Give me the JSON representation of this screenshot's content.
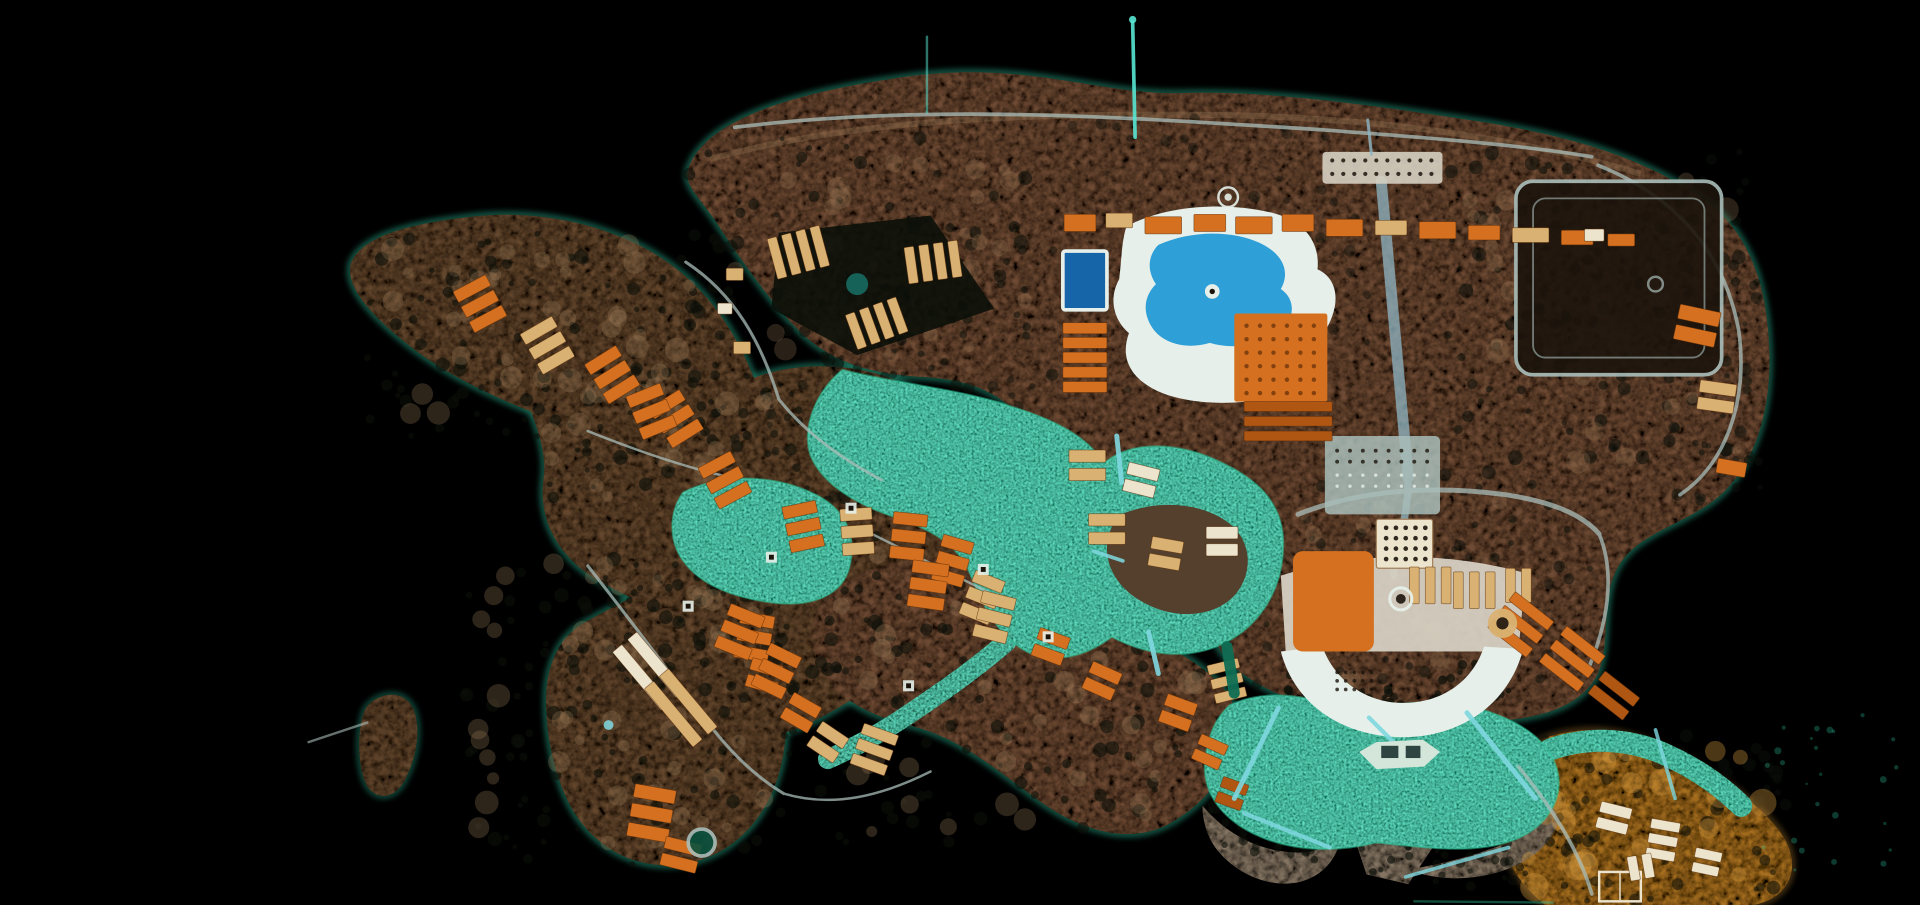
{
  "meta": {
    "title": "Aerial satellite photograph of an island lagoon resort at night, viewed from directly above on black water"
  },
  "palette": {
    "background": "#000000",
    "land": "#6e4c34",
    "land2": "#63462f",
    "land_dark": "#54402c",
    "land_light": "#a3805c",
    "gold": "#a76f24",
    "gold_light": "#d89a3e",
    "island_gray": "#857663",
    "scrub": "#0b0f09",
    "lagoon": "#0e6e54",
    "lagoon_deep": "#0a523e",
    "lagoon_bright": "#2fc49a",
    "pool_blue": "#2f9fd8",
    "pool_deep": "#1565a8",
    "deck": "#e6efe9",
    "plaza": "#d6d0c2",
    "roof_orange": "#d4701f",
    "roof_orange_dark": "#b05613",
    "roof_tan": "#d9b273",
    "building_white": "#ece4cc",
    "road": "#a9bdb9",
    "road_teal": "#8fb6c4",
    "bridge_cyan": "#7fd8e0",
    "mast": "#58e6d2",
    "coast_glow": "#35e0b4",
    "court_dark": "#1c140c",
    "water_feature": "#176a60",
    "pergola_dark": "#7a3c0e",
    "boat_white": "#d4e6da",
    "boat_dark": "#2e4440",
    "villa_stroke": "#5a2c08"
  },
  "map": {
    "villa_clusters": [
      [
        392,
        248,
        -28,
        3,
        30,
        10,
        4,
        "roof_orange"
      ],
      [
        447,
        282,
        -30,
        3,
        30,
        10,
        4,
        "roof_tan"
      ],
      [
        500,
        306,
        -32,
        3,
        30,
        10,
        4,
        "roof_orange"
      ],
      [
        552,
        342,
        -32,
        3,
        30,
        10,
        4,
        "roof_orange"
      ],
      [
        592,
        392,
        -28,
        3,
        30,
        10,
        4,
        "roof_orange"
      ],
      [
        532,
        336,
        -22,
        3,
        30,
        10,
        4,
        "roof_orange"
      ],
      [
        656,
        430,
        -12,
        3,
        28,
        10,
        4,
        "roof_orange"
      ],
      [
        700,
        434,
        -4,
        3,
        26,
        10,
        4,
        "roof_tan"
      ],
      [
        742,
        438,
        6,
        3,
        28,
        10,
        4,
        "roof_orange"
      ],
      [
        778,
        458,
        16,
        3,
        26,
        10,
        4,
        "roof_orange"
      ],
      [
        802,
        488,
        22,
        3,
        26,
        10,
        4,
        "roof_tan"
      ],
      [
        616,
        520,
        10,
        3,
        28,
        10,
        4,
        "roof_orange"
      ],
      [
        624,
        552,
        16,
        2,
        26,
        10,
        4,
        "roof_orange"
      ],
      [
        758,
        478,
        8,
        3,
        30,
        10,
        4,
        "roof_orange"
      ],
      [
        812,
        504,
        14,
        3,
        28,
        10,
        4,
        "roof_tan"
      ],
      [
        858,
        528,
        20,
        2,
        26,
        10,
        4,
        "roof_orange"
      ],
      [
        900,
        556,
        24,
        2,
        26,
        10,
        4,
        "roof_orange"
      ],
      [
        962,
        582,
        20,
        2,
        26,
        10,
        4,
        "roof_orange"
      ],
      [
        988,
        614,
        24,
        2,
        24,
        9,
        4,
        "roof_orange"
      ],
      [
        1006,
        648,
        20,
        2,
        22,
        9,
        4,
        "roof_orange_dark"
      ],
      [
        604,
        516,
        22,
        3,
        30,
        10,
        4,
        "roof_orange"
      ],
      [
        634,
        548,
        26,
        3,
        28,
        10,
        4,
        "roof_orange"
      ],
      [
        654,
        582,
        30,
        2,
        26,
        10,
        4,
        "roof_orange"
      ],
      [
        676,
        606,
        34,
        2,
        26,
        10,
        4,
        "roof_tan"
      ],
      [
        714,
        612,
        20,
        3,
        30,
        9,
        4,
        "roof_tan"
      ],
      [
        532,
        664,
        10,
        3,
        34,
        11,
        5,
        "roof_orange"
      ],
      [
        556,
        698,
        14,
        2,
        30,
        10,
        4,
        "roof_orange"
      ],
      [
        530,
        548,
        50,
        2,
        62,
        10,
        6,
        "building_white"
      ],
      [
        556,
        578,
        50,
        2,
        62,
        10,
        6,
        "roof_tan"
      ],
      [
        886,
        292,
        0,
        5,
        36,
        9,
        3,
        "roof_orange"
      ],
      [
        1052,
        344,
        0,
        3,
        72,
        8,
        4,
        "roof_orange_dark"
      ],
      [
        882,
        182,
        0,
        1,
        26,
        14,
        0,
        "roof_orange"
      ],
      [
        914,
        180,
        0,
        1,
        22,
        12,
        0,
        "roof_tan"
      ],
      [
        950,
        184,
        0,
        1,
        30,
        14,
        0,
        "roof_orange"
      ],
      [
        988,
        182,
        0,
        1,
        26,
        14,
        0,
        "roof_orange"
      ],
      [
        1024,
        184,
        0,
        1,
        30,
        14,
        0,
        "roof_orange"
      ],
      [
        1060,
        182,
        0,
        1,
        26,
        14,
        0,
        "roof_orange"
      ],
      [
        1098,
        186,
        0,
        1,
        30,
        14,
        0,
        "roof_orange"
      ],
      [
        1136,
        186,
        0,
        1,
        26,
        12,
        0,
        "roof_tan"
      ],
      [
        1174,
        188,
        0,
        1,
        30,
        14,
        0,
        "roof_orange"
      ],
      [
        1212,
        190,
        0,
        1,
        26,
        12,
        0,
        "roof_orange"
      ],
      [
        1250,
        192,
        0,
        1,
        30,
        12,
        0,
        "roof_tan"
      ],
      [
        1288,
        194,
        0,
        1,
        26,
        12,
        0,
        "roof_orange"
      ],
      [
        1324,
        196,
        0,
        1,
        22,
        10,
        0,
        "roof_orange"
      ],
      [
        652,
        206,
        75,
        4,
        34,
        8,
        4,
        "roof_tan"
      ],
      [
        762,
        214,
        82,
        4,
        30,
        8,
        4,
        "roof_tan"
      ],
      [
        716,
        264,
        70,
        4,
        30,
        8,
        4,
        "roof_tan"
      ],
      [
        600,
        224,
        0,
        1,
        14,
        10,
        0,
        "roof_tan"
      ],
      [
        592,
        252,
        0,
        1,
        12,
        9,
        0,
        "building_white"
      ],
      [
        606,
        284,
        0,
        1,
        14,
        10,
        0,
        "roof_tan"
      ],
      [
        888,
        380,
        0,
        2,
        30,
        10,
        5,
        "roof_tan"
      ],
      [
        932,
        392,
        14,
        2,
        26,
        10,
        4,
        "building_white"
      ],
      [
        904,
        432,
        0,
        2,
        30,
        10,
        5,
        "roof_tan"
      ],
      [
        952,
        452,
        10,
        2,
        26,
        10,
        4,
        "roof_tan"
      ],
      [
        998,
        442,
        0,
        2,
        26,
        10,
        4,
        "building_white"
      ],
      [
        1168,
        478,
        90,
        3,
        30,
        8,
        5,
        "roof_tan"
      ],
      [
        1204,
        482,
        90,
        3,
        30,
        8,
        5,
        "roof_tan"
      ],
      [
        1240,
        478,
        90,
        2,
        28,
        8,
        5,
        "roof_tan"
      ],
      [
        1242,
        510,
        38,
        3,
        40,
        9,
        5,
        "roof_orange"
      ],
      [
        1284,
        538,
        38,
        3,
        40,
        9,
        5,
        "roof_orange"
      ],
      [
        1318,
        568,
        38,
        2,
        36,
        9,
        5,
        "roof_orange_dark"
      ],
      [
        1002,
        556,
        -14,
        3,
        26,
        8,
        4,
        "roof_tan"
      ],
      [
        1386,
        266,
        12,
        2,
        34,
        12,
        5,
        "roof_orange"
      ],
      [
        1402,
        324,
        8,
        2,
        30,
        10,
        4,
        "roof_tan"
      ],
      [
        1414,
        382,
        10,
        1,
        24,
        12,
        0,
        "roof_orange"
      ],
      [
        1302,
        192,
        0,
        1,
        16,
        10,
        0,
        "building_white"
      ],
      [
        1318,
        668,
        14,
        2,
        26,
        9,
        4,
        "building_white"
      ],
      [
        1358,
        686,
        10,
        3,
        24,
        8,
        4,
        "building_white"
      ],
      [
        1394,
        704,
        12,
        2,
        22,
        8,
        4,
        "building_white"
      ],
      [
        1340,
        708,
        80,
        2,
        20,
        8,
        4,
        "building_white"
      ]
    ],
    "scrub_fields": [
      [
        300,
        185,
        300,
        180,
        90,
        7,
        2,
        6,
        "scrub",
        0.6
      ],
      [
        560,
        110,
        280,
        200,
        80,
        11,
        2,
        6,
        "scrub",
        0.55
      ],
      [
        430,
        300,
        320,
        250,
        110,
        13,
        2,
        6,
        "scrub",
        0.6
      ],
      [
        380,
        450,
        270,
        260,
        110,
        17,
        2,
        6,
        "scrub",
        0.6
      ],
      [
        670,
        460,
        330,
        230,
        100,
        19,
        2,
        6,
        "scrub",
        0.6
      ],
      [
        1180,
        120,
        250,
        280,
        110,
        23,
        2,
        6,
        "scrub",
        0.55
      ],
      [
        860,
        95,
        260,
        235,
        55,
        29,
        2,
        5,
        "scrub",
        0.4
      ],
      [
        1230,
        600,
        230,
        139,
        70,
        31,
        2,
        6,
        "scrub",
        0.55
      ],
      [
        1020,
        390,
        280,
        190,
        80,
        37,
        2,
        5,
        "scrub",
        0.5
      ],
      [
        600,
        300,
        260,
        120,
        60,
        41,
        2,
        5,
        "scrub",
        0.5
      ],
      [
        1052,
        546,
        52,
        26,
        16,
        43,
        2,
        4,
        "scrub",
        0.7
      ],
      [
        1108,
        562,
        70,
        20,
        18,
        47,
        2,
        4,
        "scrub",
        0.7
      ],
      [
        1178,
        540,
        56,
        30,
        16,
        53,
        2,
        4,
        "scrub",
        0.7
      ],
      [
        1252,
        162,
        140,
        132,
        55,
        59,
        2,
        5,
        "scrub",
        0.6
      ],
      [
        1108,
        662,
        66,
        50,
        22,
        61,
        2,
        4,
        "scrub",
        0.65
      ],
      [
        1000,
        662,
        90,
        40,
        20,
        67,
        2,
        4,
        "scrub",
        0.6
      ],
      [
        1150,
        690,
        90,
        34,
        18,
        71,
        2,
        4,
        "scrub",
        0.6
      ],
      [
        1360,
        230,
        80,
        180,
        40,
        73,
        2,
        5,
        "scrub",
        0.5
      ],
      [
        320,
        195,
        260,
        150,
        40,
        83,
        4,
        10,
        "land_light",
        0.28
      ],
      [
        600,
        130,
        240,
        160,
        30,
        89,
        4,
        10,
        "land_light",
        0.25
      ],
      [
        450,
        320,
        280,
        220,
        40,
        97,
        4,
        10,
        "land_light",
        0.28
      ],
      [
        390,
        460,
        240,
        230,
        40,
        101,
        4,
        10,
        "land_light",
        0.28
      ],
      [
        700,
        480,
        280,
        200,
        35,
        103,
        4,
        10,
        "land_light",
        0.28
      ],
      [
        1200,
        140,
        220,
        240,
        35,
        107,
        4,
        10,
        "land_light",
        0.25
      ],
      [
        1240,
        610,
        200,
        120,
        30,
        109,
        5,
        12,
        "gold_light",
        0.35
      ],
      [
        1060,
        400,
        200,
        160,
        25,
        113,
        4,
        9,
        "land_light",
        0.25
      ],
      [
        1440,
        580,
        110,
        140,
        25,
        127,
        1,
        3,
        "lagoon_bright",
        0.3
      ]
    ],
    "dot_grids": [
      [
        1088,
        131,
        10,
        2,
        9,
        11,
        1.7,
        "court_dark",
        0.85
      ],
      [
        1132,
        431,
        5,
        4,
        8,
        8.5,
        1.9,
        "court_dark",
        0.9
      ],
      [
        1092,
        549,
        5,
        3,
        7,
        7,
        1.5,
        "court_dark",
        0.8
      ],
      [
        1018,
        266,
        6,
        6,
        11,
        11,
        1.8,
        "pergola_dark",
        0.9
      ],
      [
        1092,
        368,
        8,
        2,
        10.5,
        9,
        1.6,
        "court_dark",
        0.8
      ],
      [
        1092,
        388,
        8,
        2,
        10.5,
        9,
        1.4,
        "deck",
        0.8
      ]
    ],
    "piers": [
      [
        912,
        356,
        916,
        394,
        4,
        "bridge_cyan",
        0.9
      ],
      [
        893,
        450,
        917,
        458,
        3,
        "bridge_cyan",
        0.85
      ],
      [
        938,
        516,
        946,
        550,
        4,
        "bridge_cyan",
        0.9
      ],
      [
        1002,
        528,
        1008,
        566,
        9,
        "lagoon",
        0.95
      ],
      [
        1044,
        578,
        1008,
        652,
        4,
        "bridge_cyan",
        0.9
      ],
      [
        1118,
        586,
        1142,
        610,
        3.5,
        "bridge_cyan",
        0.9
      ],
      [
        1198,
        582,
        1254,
        652,
        4,
        "bridge_cyan",
        0.9
      ],
      [
        1016,
        664,
        1086,
        692,
        3.5,
        "bridge_cyan",
        0.85
      ],
      [
        1148,
        716,
        1232,
        692,
        3,
        "bridge_cyan",
        0.8
      ],
      [
        1352,
        596,
        1368,
        652,
        3,
        "bridge_cyan",
        0.8
      ],
      [
        925,
        18,
        927,
        112,
        3,
        "mast",
        0.9
      ],
      [
        757,
        30,
        757,
        92,
        2,
        "mast",
        0.5
      ],
      [
        252,
        606,
        300,
        590,
        2,
        "road",
        0.6
      ],
      [
        1117,
        98,
        1120,
        126,
        2.5,
        "road_teal",
        0.8
      ],
      [
        1155,
        736,
        1268,
        737,
        2,
        "lagoon_bright",
        0.4
      ]
    ],
    "circles": [
      [
        1003,
        161,
        8,
        null,
        "deck",
        2,
        0.9
      ],
      [
        1003,
        161,
        3,
        "deck",
        null,
        0,
        0.9
      ],
      [
        1144,
        489,
        9,
        null,
        "deck",
        2.5,
        0.95
      ],
      [
        1144,
        489,
        4,
        "court_dark",
        null,
        0,
        0.9
      ],
      [
        1227,
        509,
        12,
        "roof_tan",
        null,
        0,
        0.95
      ],
      [
        1227,
        509,
        5,
        "court_dark",
        null,
        0,
        0.9
      ],
      [
        573,
        688,
        11,
        "lagoon_deep",
        "road",
        3,
        0.9
      ],
      [
        700,
        232,
        9,
        "water_feature",
        null,
        0,
        0.9
      ],
      [
        497,
        592,
        4,
        "bridge_cyan",
        null,
        0,
        0.85
      ],
      [
        925,
        16,
        3,
        "mast",
        null,
        0,
        0.9
      ],
      [
        1352,
        232,
        6,
        null,
        "road",
        2,
        0.7
      ]
    ],
    "pads": [
      [
        630,
        455
      ],
      [
        562,
        495
      ],
      [
        695,
        415
      ],
      [
        803,
        465
      ],
      [
        856,
        520
      ],
      [
        742,
        560
      ]
    ]
  }
}
